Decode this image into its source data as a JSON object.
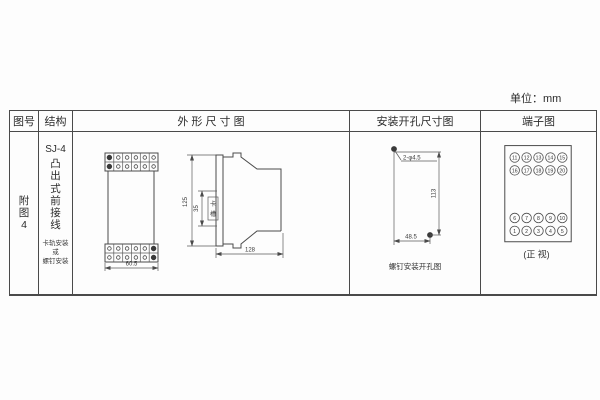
{
  "unit_label": "单位：mm",
  "table_headers": {
    "figure_no": "图号",
    "structure": "结构",
    "outline": "外 形 尺 寸 图",
    "mounting": "安装开孔尺寸图",
    "terminal": "端子图"
  },
  "figure_column": {
    "chars": [
      "附",
      "图",
      "4"
    ]
  },
  "structure_column": {
    "model": "SJ-4",
    "type_chars": [
      "凸",
      "出",
      "式",
      "前",
      "接",
      "线"
    ],
    "mount_note_lines": [
      "卡轨安装",
      "或",
      "螺钉安装"
    ]
  },
  "outline_drawing": {
    "front_width": "60.5",
    "height": "125",
    "slot_height": "35",
    "slot_label_chars": [
      "卡",
      "槽"
    ],
    "depth": "128"
  },
  "mounting_drawing": {
    "holes_label": "2-φ4.5",
    "vertical_spacing": "113",
    "horizontal_spacing": "48.5",
    "caption": "螺钉安装开孔图"
  },
  "terminal_diagram": {
    "top_rows": [
      [
        "11",
        "12",
        "13",
        "14",
        "15"
      ],
      [
        "16",
        "17",
        "18",
        "19",
        "20"
      ]
    ],
    "bottom_rows": [
      [
        "6",
        "7",
        "8",
        "9",
        "10"
      ],
      [
        "1",
        "2",
        "3",
        "4",
        "5"
      ]
    ],
    "caption": "(正 视)"
  }
}
